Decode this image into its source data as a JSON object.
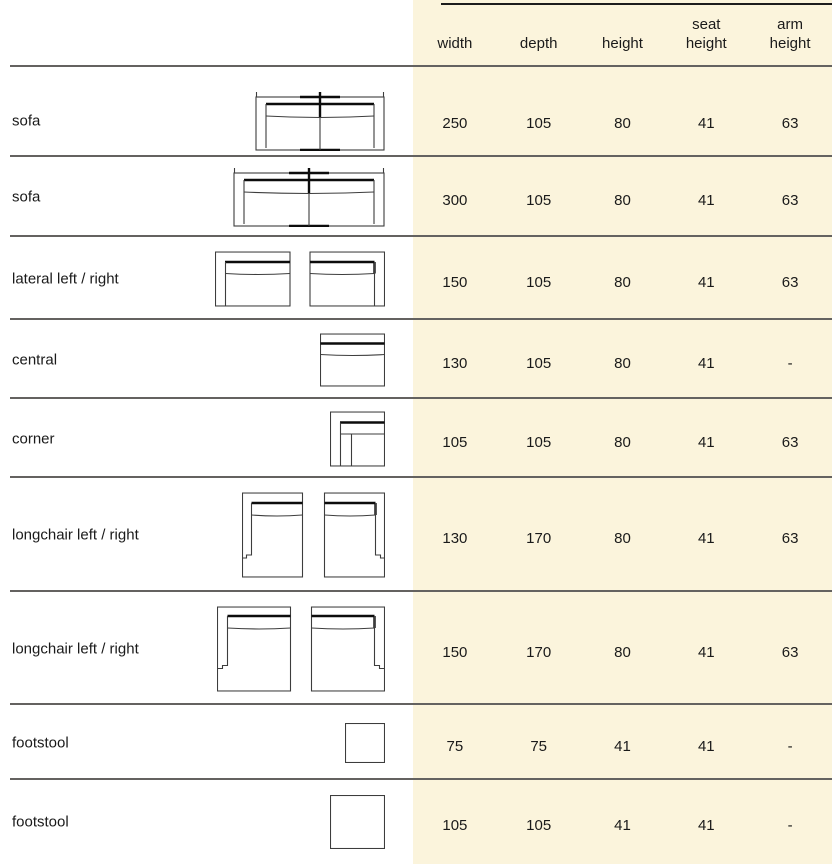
{
  "table": {
    "headers": [
      [
        "width"
      ],
      [
        "depth"
      ],
      [
        "height"
      ],
      [
        "seat",
        "height"
      ],
      [
        "arm",
        "height"
      ]
    ],
    "rows": [
      {
        "label": "sofa",
        "drawing": "sofa-2seat-250-plan",
        "values": [
          "250",
          "105",
          "80",
          "41",
          "63"
        ]
      },
      {
        "label": "sofa",
        "drawing": "sofa-2seat-300-plan",
        "values": [
          "300",
          "105",
          "80",
          "41",
          "63"
        ]
      },
      {
        "label": "lateral left / right",
        "drawing": "lateral-pair-plan",
        "values": [
          "150",
          "105",
          "80",
          "41",
          "63"
        ]
      },
      {
        "label": "central",
        "drawing": "central-plan",
        "values": [
          "130",
          "105",
          "80",
          "41",
          "-"
        ]
      },
      {
        "label": "corner",
        "drawing": "corner-plan",
        "values": [
          "105",
          "105",
          "80",
          "41",
          "63"
        ]
      },
      {
        "label": "longchair left / right",
        "drawing": "longchair-130-pair-plan",
        "values": [
          "130",
          "170",
          "80",
          "41",
          "63"
        ]
      },
      {
        "label": "longchair left / right",
        "drawing": "longchair-150-pair-plan",
        "values": [
          "150",
          "170",
          "80",
          "41",
          "63"
        ]
      },
      {
        "label": "footstool",
        "drawing": "footstool-75-plan",
        "values": [
          "75",
          "75",
          "41",
          "41",
          "-"
        ]
      },
      {
        "label": "footstool",
        "drawing": "footstool-105-plan",
        "values": [
          "105",
          "105",
          "41",
          "41",
          "-"
        ]
      }
    ]
  },
  "colors": {
    "panel_bg": "#FBF4DC",
    "separator": "#646260",
    "top_rule": "#1c1c1c",
    "text": "#1a1a1a"
  }
}
